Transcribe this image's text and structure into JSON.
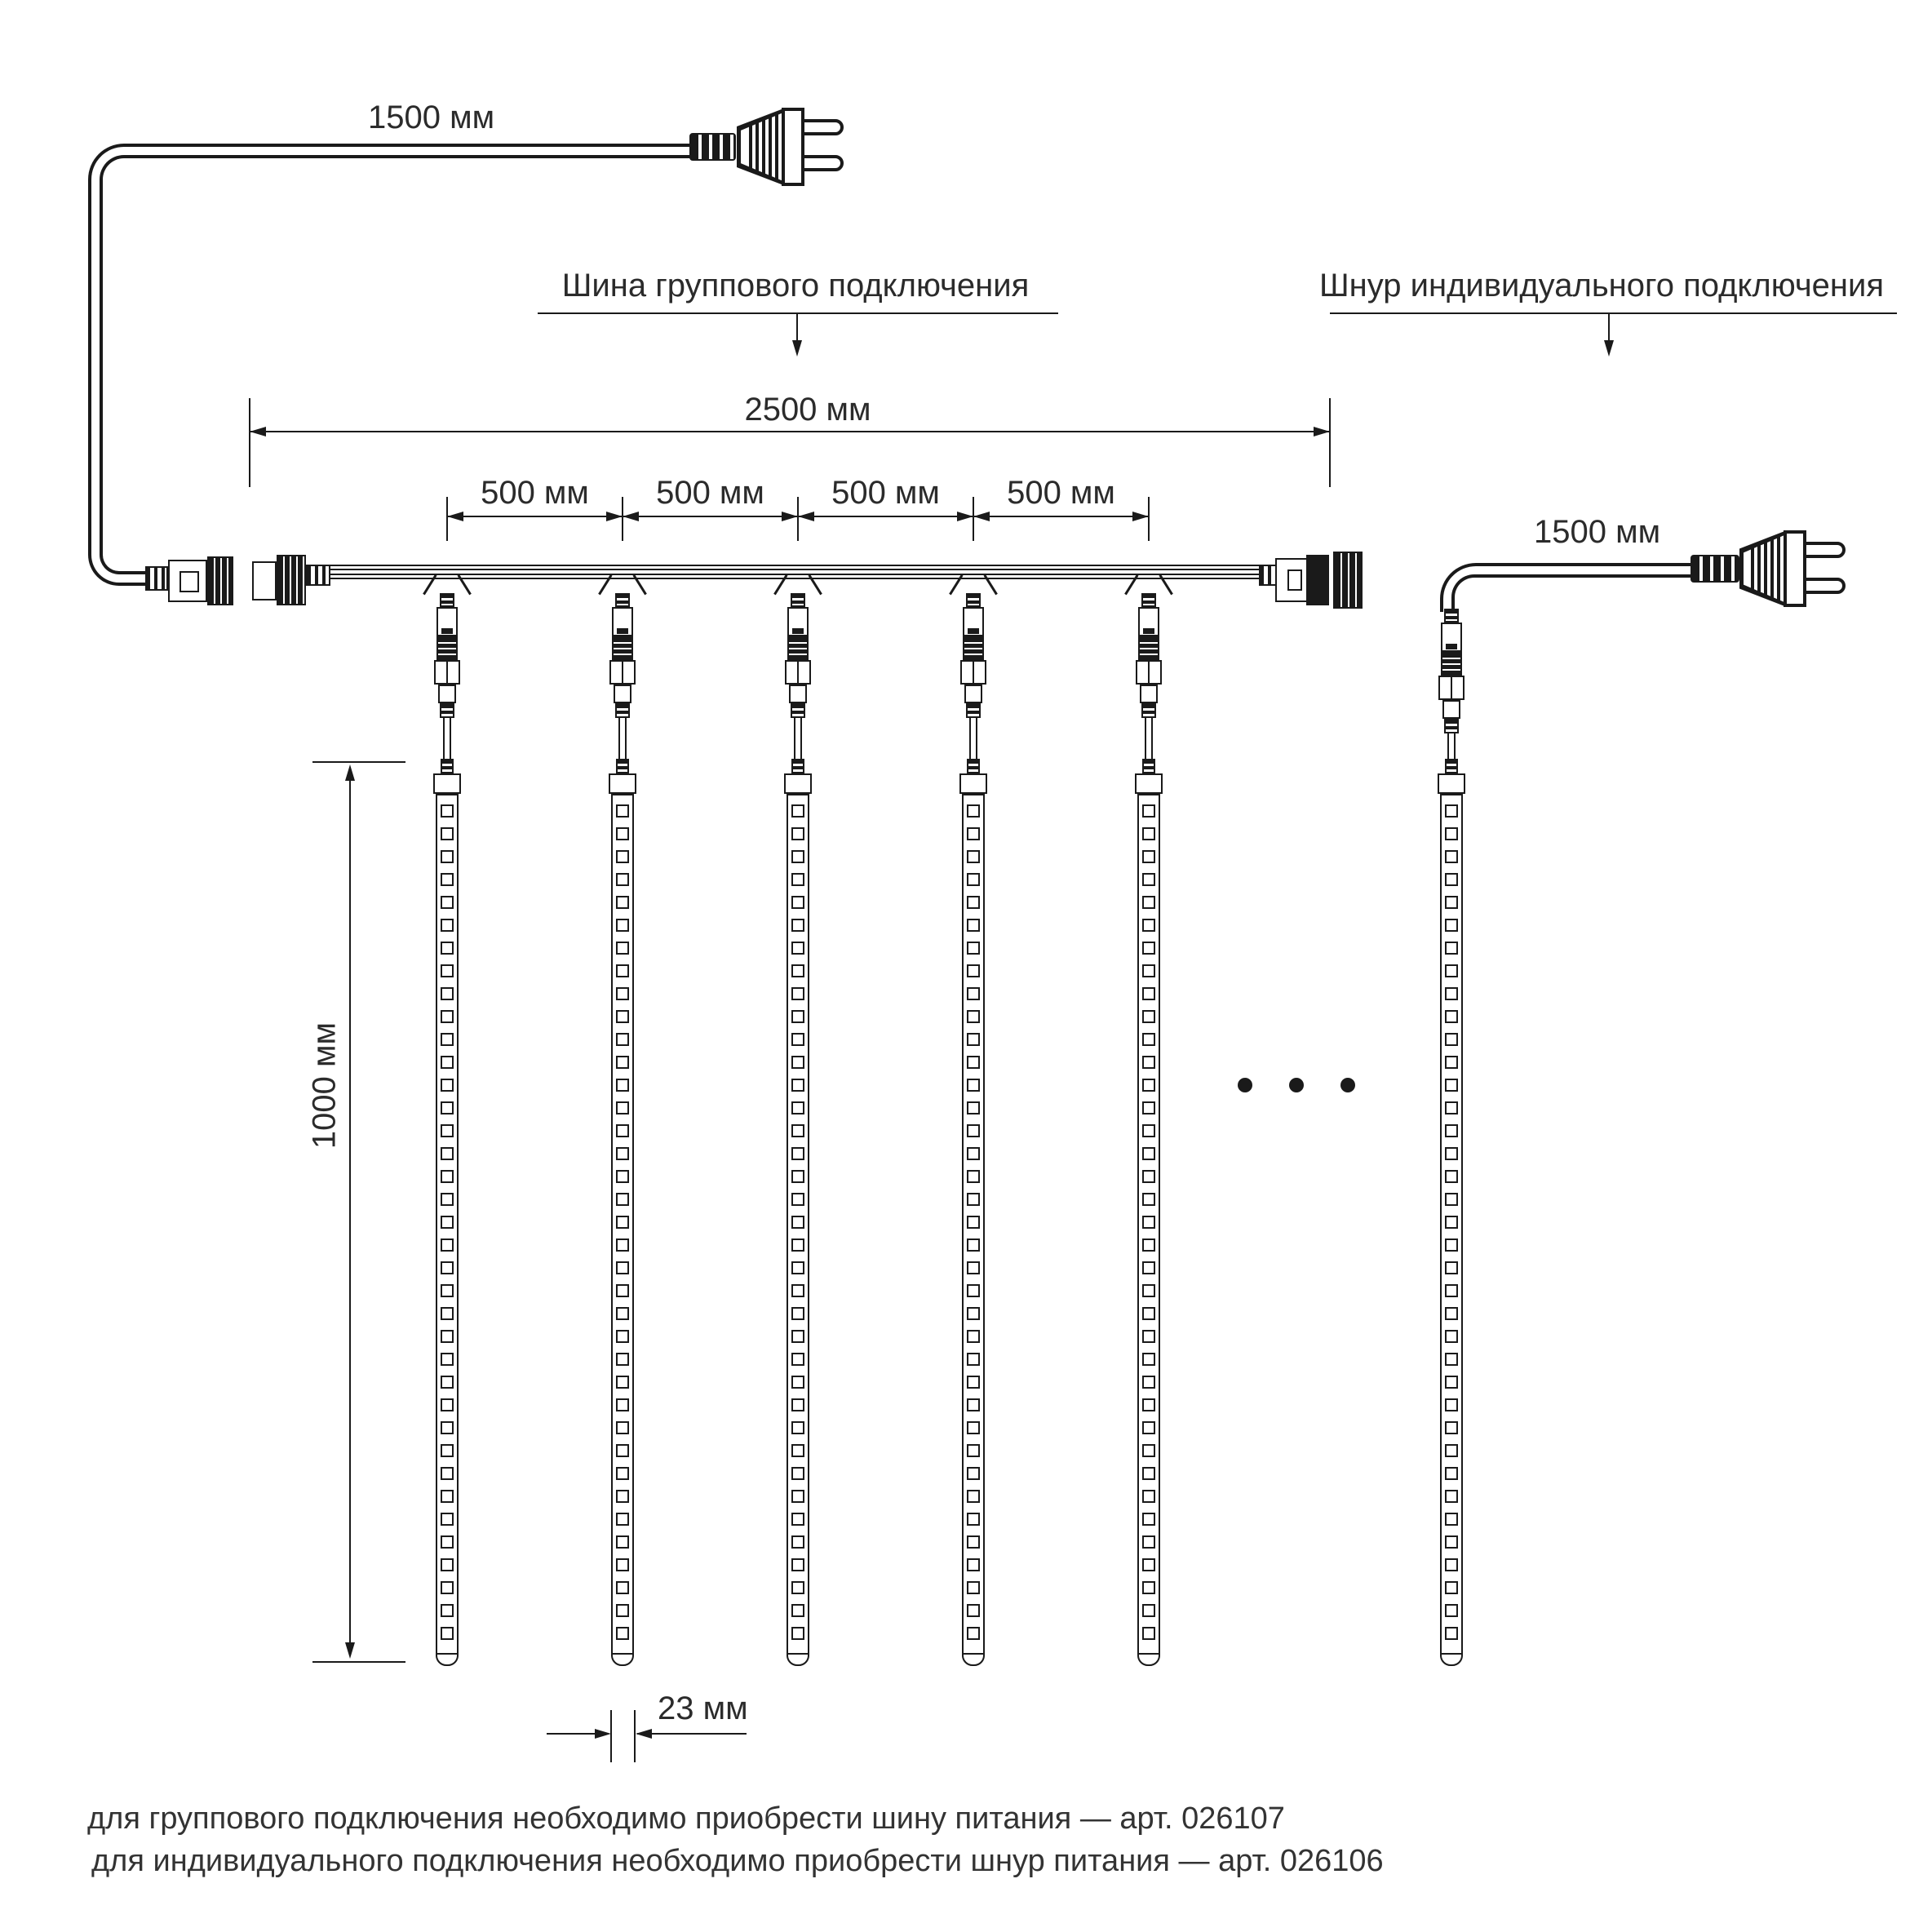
{
  "callouts": {
    "bus": "Шина группового подключения",
    "individual": "Шнур индивидуального подключения"
  },
  "dimensions": {
    "input_cord_length": "1500 мм",
    "bus_length": "2500 мм",
    "segment_length": "500 мм",
    "tube_drop_length": "1000 мм",
    "individual_cord_length": "1500 мм",
    "tube_width": "23 мм"
  },
  "notes": {
    "group": "для группового подключения необходимо приобрести шину питания — арт. 026107",
    "individual": "для индивидуального подключения необходимо приобрести шнур питания — арт. 026106"
  },
  "counts": {
    "bus_tubes": 5,
    "segments": 4,
    "leds_per_tube": 37,
    "ellipsis_dots": 3
  },
  "colors": {
    "stroke": "#1a1a1a",
    "background": "#ffffff"
  }
}
